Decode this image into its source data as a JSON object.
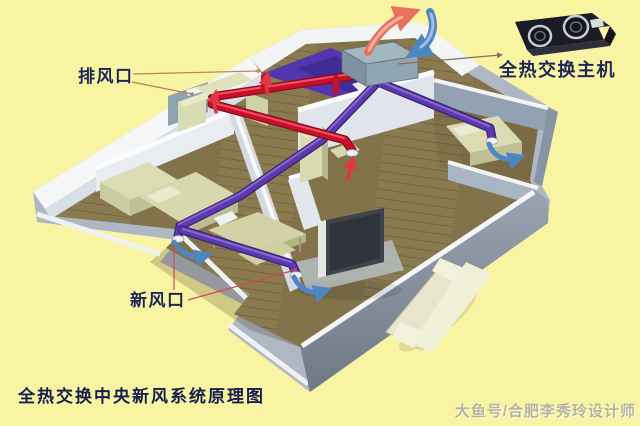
{
  "page": {
    "background_color": "#F9F4A2"
  },
  "diagram": {
    "title": "全热交换中央新风系统原理图",
    "watermark": "大鱼号/合肥李秀玲设计师",
    "callouts": {
      "exhaust_vent_label": "排风口",
      "fresh_air_vent_label": "新风口",
      "main_unit_label": "全热交换主机"
    },
    "colors": {
      "exhaust_duct": "#C01028",
      "supply_duct": "#4A2B94",
      "exhaust_airflow_arrow": "#E8705C",
      "fresh_airflow_arrow": "#4E86C4",
      "label_text": "#1C2757",
      "wood_floor": "#8A7A50",
      "bathroom_floor": "#5236B0",
      "wall": "#DDE3EA",
      "product_body": "#1B1B27"
    }
  }
}
